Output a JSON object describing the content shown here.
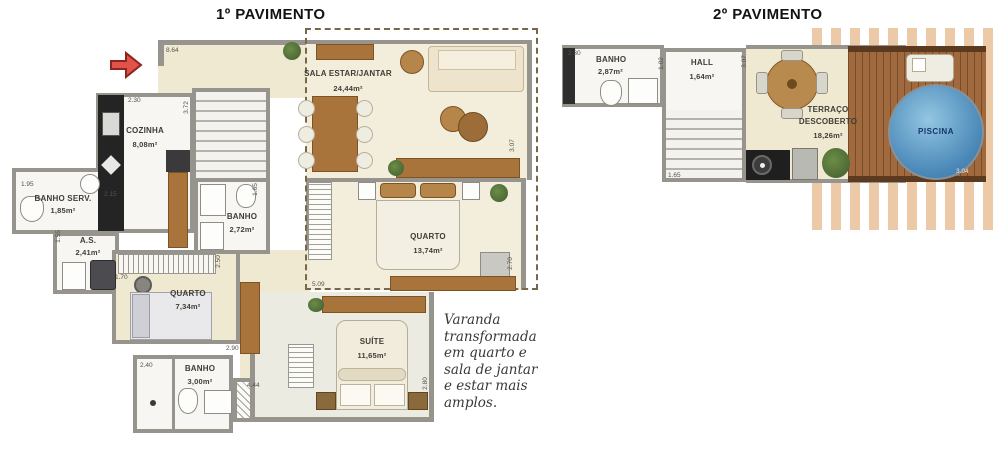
{
  "floor1": {
    "title": "1º PAVIMENTO",
    "rooms": {
      "sala": {
        "name": "SALA ESTAR/JANTAR",
        "area": "24,44m²"
      },
      "cozinha": {
        "name": "COZINHA",
        "area": "8,08m²"
      },
      "banho_serv": {
        "name": "BANHO SERV.",
        "area": "1,85m²"
      },
      "as": {
        "name": "A.S.",
        "area": "2,41m²"
      },
      "banho1": {
        "name": "BANHO",
        "area": "2,72m²"
      },
      "quarto1": {
        "name": "QUARTO",
        "area": "7,34m²"
      },
      "quarto2": {
        "name": "QUARTO",
        "area": "13,74m²"
      },
      "banho2": {
        "name": "BANHO",
        "area": "3,00m²"
      },
      "suite": {
        "name": "SUÍTE",
        "area": "11,65m²"
      }
    },
    "dims": {
      "entry": "8.64",
      "cozinha_w": "2.30",
      "cozinha_h": "3.72",
      "cozinha_b": "2.15",
      "banho_serv_w": "1.95",
      "as_h": "1.55",
      "as_b": "1.70",
      "banho1_h": "1.65",
      "banho1_b": "2.50",
      "quarto1_b": "2.90",
      "banho2_w": "2.40",
      "closet": "4.44",
      "sala_h": "3.07",
      "quarto2_h": "2.70",
      "quarto2_b": "5.09",
      "suite_h": "2.80"
    },
    "note_lines": [
      "Varanda",
      "transformada",
      "em quarto e",
      "sala de jantar",
      "e estar mais",
      "amplos."
    ]
  },
  "floor2": {
    "title": "2º PAVIMENTO",
    "rooms": {
      "banho": {
        "name": "BANHO",
        "area": "2,87m²"
      },
      "hall": {
        "name": "HALL",
        "area": "1,64m²"
      },
      "terraco": {
        "name_line1": "TERRAÇO",
        "name_line2": "DESCOBERTO",
        "area": "18,26m²"
      },
      "piscina": {
        "name": "PISCINA"
      }
    },
    "dims": {
      "banho_w": "2.30",
      "hall_h": "1.02",
      "terraco_h": "3.07",
      "stairs_b": "1.65",
      "deck_b": "3.04"
    }
  },
  "colors": {
    "wall_gray": "#96948c",
    "floor_cream": "#f0e9d2",
    "pool_blue": "#4a88b8",
    "deck_wood": "#a06a3e",
    "pergola_tan": "#eccaa7",
    "entry_arrow_red": "#e0524a"
  }
}
